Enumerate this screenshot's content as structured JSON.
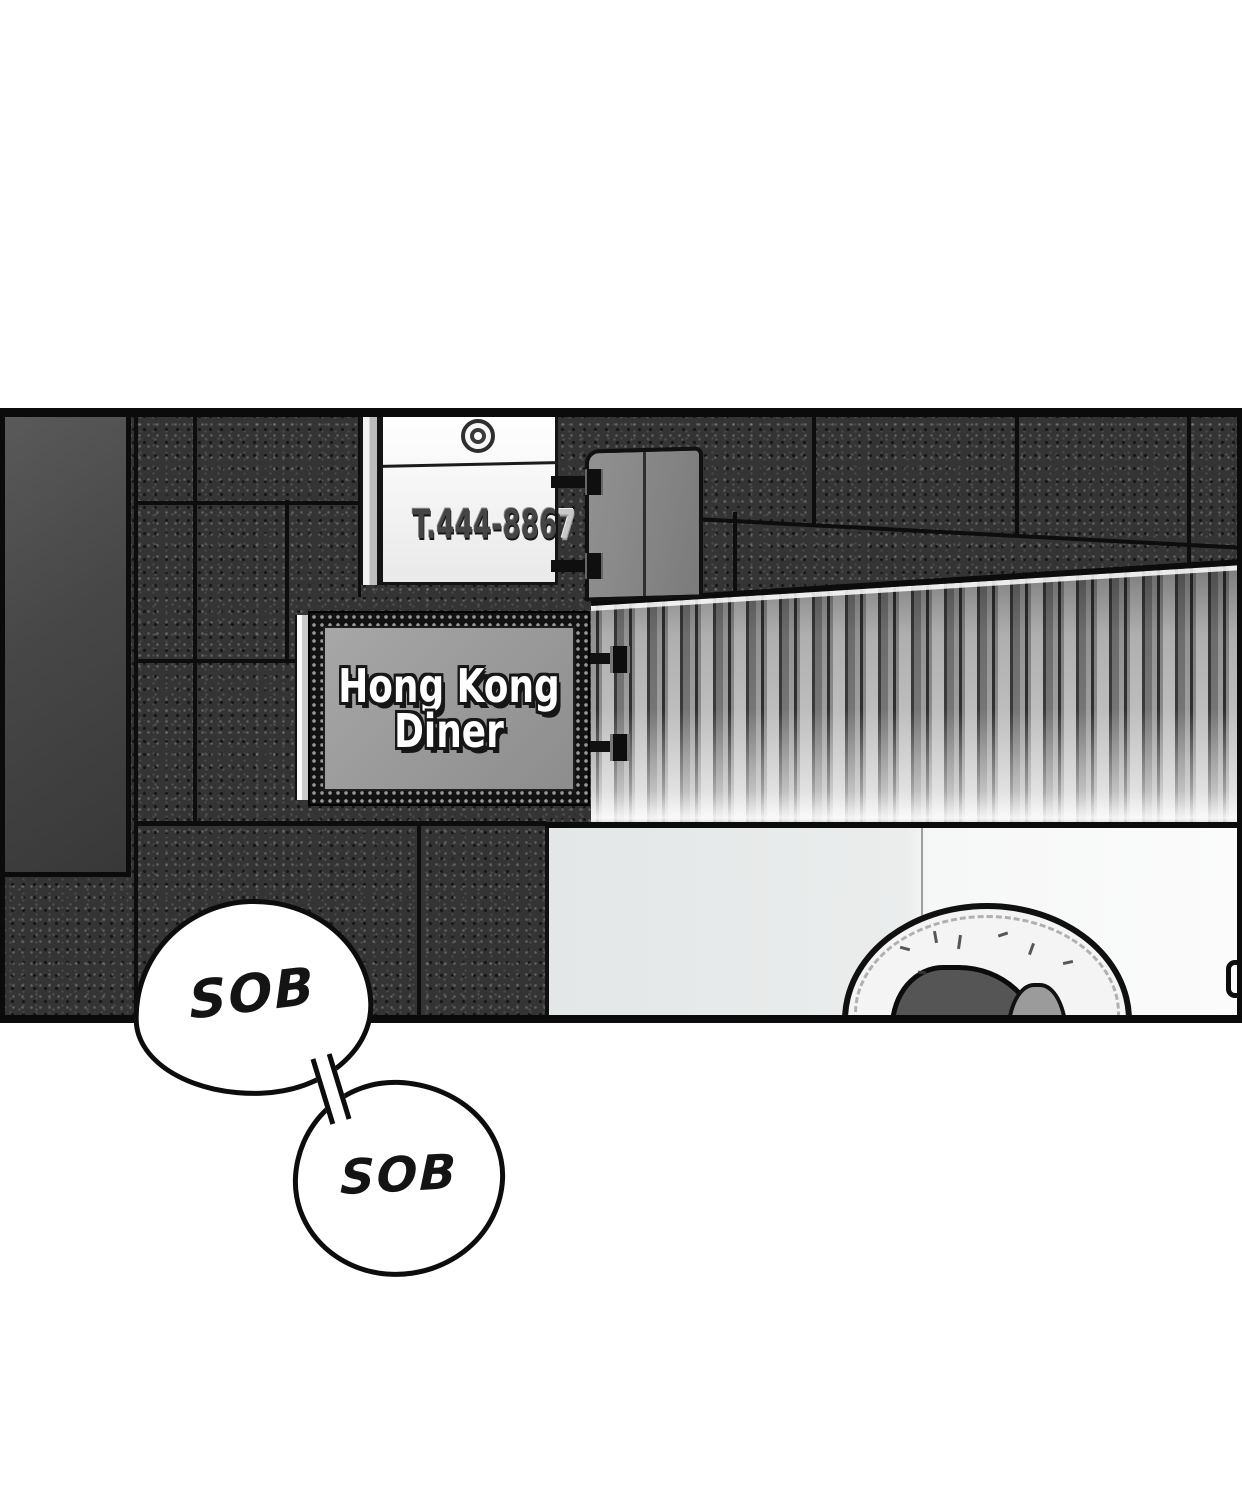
{
  "panel": {
    "phone_sign": {
      "text_main": "T.444-886",
      "text_faded": "7"
    },
    "diner_sign": {
      "line1": "Hong Kong",
      "line2": "Diner"
    },
    "bubbles": [
      {
        "text": "SOB"
      },
      {
        "text": "SOB"
      }
    ]
  },
  "colors": {
    "ink": "#0d0d0d",
    "granite_wall": "#343434",
    "door_gray": "#474747",
    "sign_panel_gray": "#989898",
    "shutter_light": "#bdbdbd",
    "storefront_left": "#e7e7e7",
    "storefront_right": "#fafafa",
    "bubble_fill": "#ffffff",
    "phone_text_embossed": "#454545",
    "phone_text_faded": "#c8c8c8",
    "diner_text": "#ffffff"
  }
}
